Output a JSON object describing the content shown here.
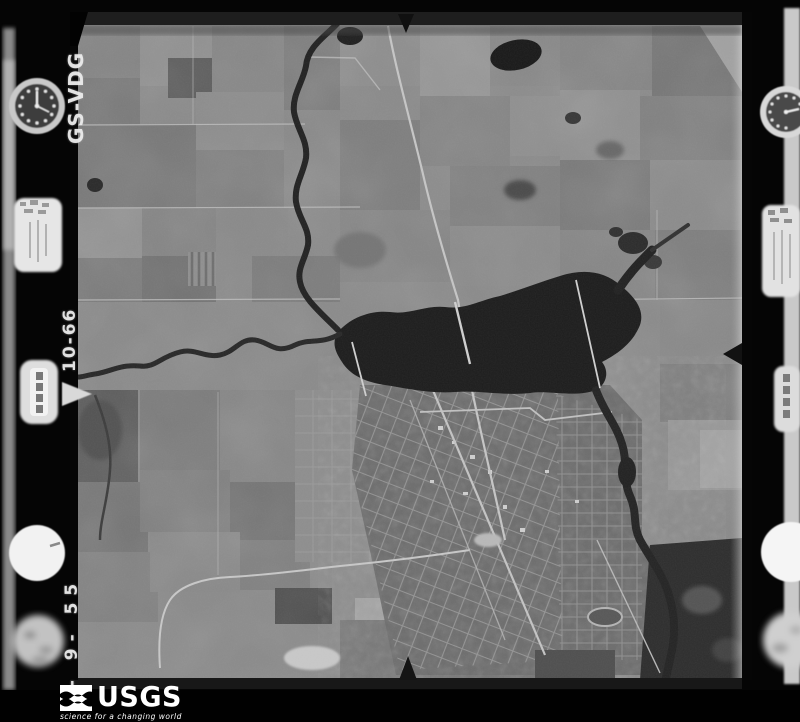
{
  "film_markings": {
    "project_code": "GS-VDG",
    "roll_frame": "10-66",
    "date": "4- 9- 55"
  },
  "footer": {
    "agency": "USGS",
    "tagline": "science for a changing world"
  },
  "instruments": {
    "left": [
      "altimeter-dial",
      "data-plate",
      "frame-counter",
      "level-bubble",
      "blurred-clock"
    ],
    "right": [
      "altimeter-dial",
      "data-plate",
      "frame-counter",
      "level-bubble",
      "blurred-clock"
    ]
  },
  "fiducial_marks": [
    "top-center",
    "bottom-center",
    "left-middle",
    "right-middle"
  ],
  "colors": {
    "background": "#000000",
    "film_band": "#1e1e1e",
    "photo_base": "#8c8c8c",
    "water": "#1f1f1f",
    "road_light": "#c6c6c6",
    "marking_text": "#eeeeee",
    "logo_text": "#ffffff"
  }
}
